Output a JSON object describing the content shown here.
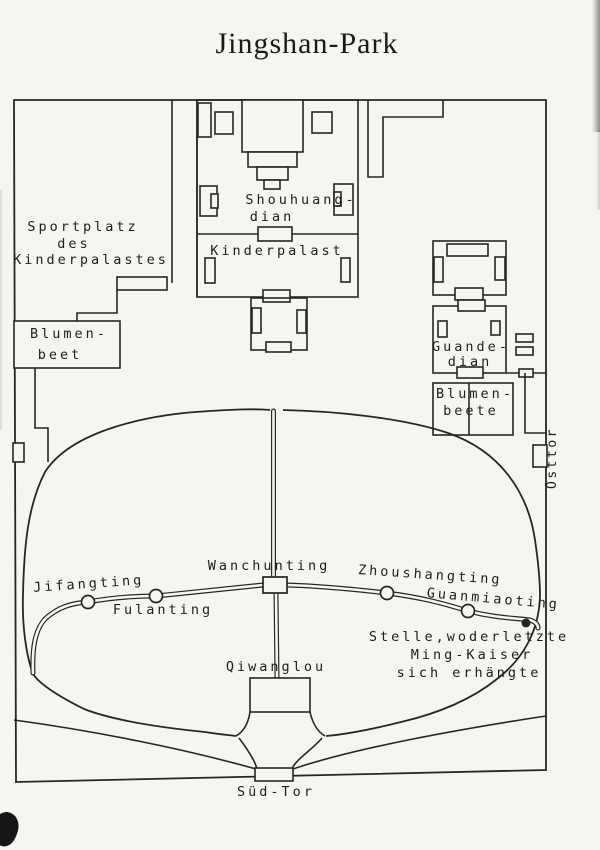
{
  "title": "Jingshan-Park",
  "colors": {
    "ink": "#262626",
    "paper": "#f6f5f0"
  },
  "areas": {
    "sportplatz": {
      "line1": "Sportplatz",
      "line2": "des",
      "line3": "Kinderpalastes"
    },
    "blumenbeet_west": {
      "line1": "Blumen-",
      "line2": "beet"
    },
    "shouhuangdian": {
      "line1": "Shouhuang-",
      "line2": "dian"
    },
    "kinderpalast": {
      "label": "Kinderpalast"
    },
    "guandedian": {
      "line1": "Guande-",
      "line2": "dian"
    },
    "blumenbeete_east": {
      "line1": "Blumen-",
      "line2": "beete"
    }
  },
  "gates": {
    "east": "Osttor",
    "south": "Süd-Tor"
  },
  "pavilions": {
    "jifangting": "Jifangting",
    "fulanting": "Fulanting",
    "wanchunting": "Wanchunting",
    "zhoushangting": "Zhoushangting",
    "guanmiaoting": "Guanmiaoting",
    "qiwanglou": "Qiwanglou"
  },
  "annotations": {
    "ming_kaiser": {
      "line1": "Stelle,woderletzte",
      "line2": "Ming-Kaiser",
      "line3": "sich erhängte"
    }
  }
}
